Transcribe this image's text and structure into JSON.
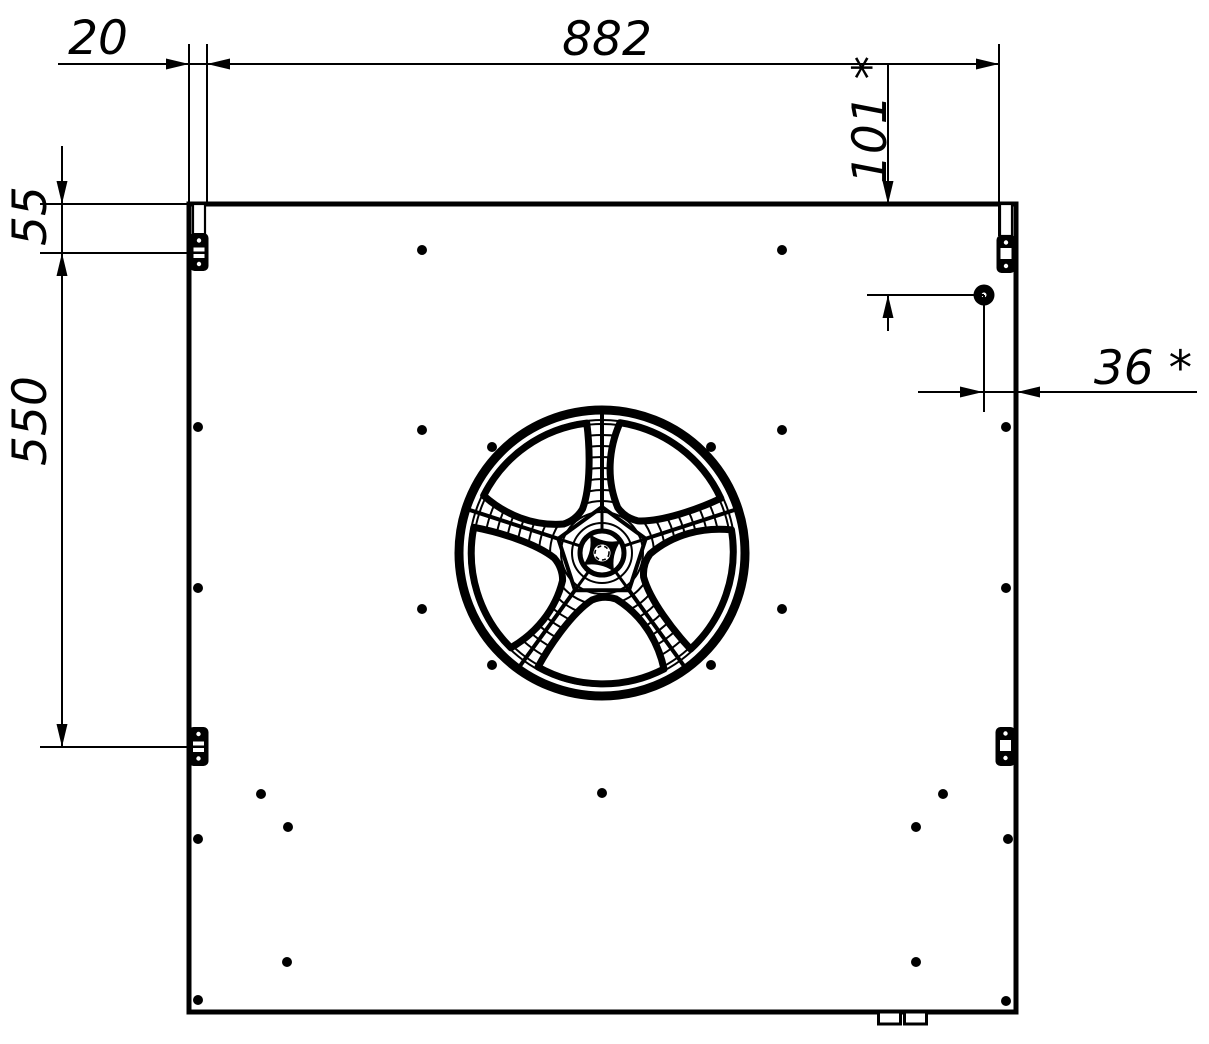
{
  "drawing": {
    "type": "technical-drawing",
    "subject": "axial-fan-panel-front-view",
    "colors": {
      "line": "#000000",
      "background": "#ffffff"
    },
    "dimension_labels": {
      "panel_left_offset": "20",
      "panel_width": "882",
      "hole_from_top": "101 *",
      "hinge_from_top": "55",
      "hinge_spacing": "550",
      "hole_from_right": "36 *"
    }
  }
}
